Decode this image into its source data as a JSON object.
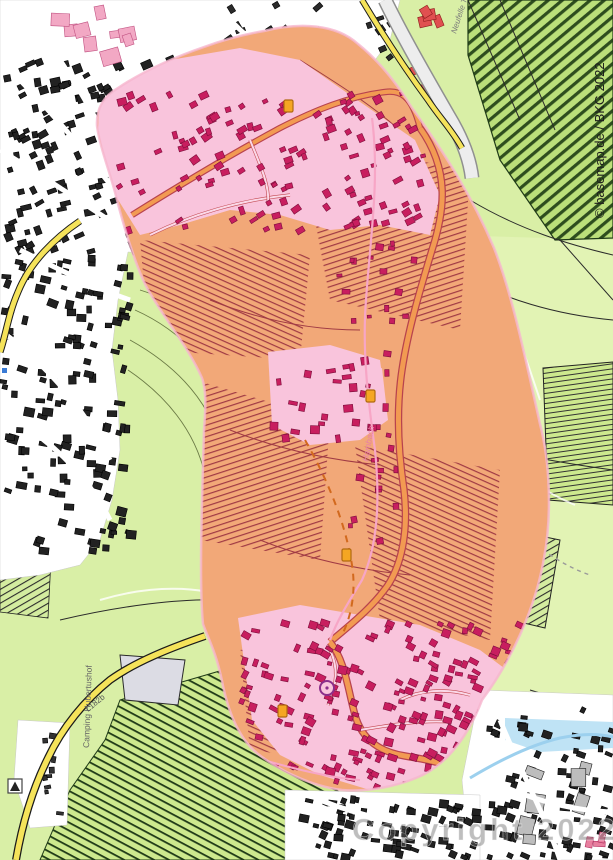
{
  "map": {
    "attribution": "© basemap.de / BKG 2022",
    "watermark": "Copyright 2022",
    "labels": {
      "camping": "Camping Hubertushof",
      "road": "L182b",
      "stream": "Hambach",
      "street": "Neufelle T."
    },
    "colors": {
      "field_green": "#D9EFA6",
      "pale_field": "#EFF6C8",
      "vine_dark": "#1F3A17",
      "urban_white": "#FFFFFF",
      "building_black": "#222222",
      "zone_orange": "#F2A878",
      "zone_pink_urban": "#F9C4DC",
      "zone_building_red": "#C81E5F",
      "zone_line_maroon": "#A03A44",
      "road_yellow": "#F5E35A",
      "road_orange": "#F29A52",
      "road_casing_red": "#B8434E",
      "stream_blue": "#BFE3F5",
      "stream_pink": "#F7A6C6",
      "shield_orange": "#F5A623"
    },
    "zones": [
      {
        "name": "impact-zone",
        "description": "red/orange analysis overlay blob covering the valley",
        "fill": "#F2A878",
        "urban_tint": "#F9C4DC"
      }
    ],
    "markers": {
      "route_shields": [
        {
          "x": 284,
          "y": 100
        },
        {
          "x": 366,
          "y": 390
        },
        {
          "x": 278,
          "y": 705
        },
        {
          "x": 342,
          "y": 549
        }
      ],
      "campsite": {
        "x": 8,
        "y": 779
      },
      "info_point": {
        "x": 2,
        "y": 368
      }
    },
    "building_clusters": [
      {
        "id": "b1",
        "x": 2,
        "y": 58,
        "w": 200,
        "h": 195,
        "n": 170,
        "s": 6.5,
        "rot": -20,
        "fill": "#222222",
        "stroke": "#000000"
      },
      {
        "id": "b2",
        "x": 0,
        "y": 255,
        "w": 128,
        "h": 295,
        "n": 130,
        "s": 6.5,
        "rot": 10,
        "fill": "#222222",
        "stroke": "#000000"
      },
      {
        "id": "b3",
        "x": 215,
        "y": 4,
        "w": 175,
        "h": 105,
        "n": 60,
        "s": 6,
        "rot": -30,
        "fill": "#2a2a2a",
        "stroke": "#000000"
      },
      {
        "id": "b4",
        "x": 487,
        "y": 705,
        "w": 124,
        "h": 150,
        "n": 75,
        "s": 6,
        "rot": 15,
        "fill": "#222222",
        "stroke": "#000000"
      },
      {
        "id": "b5",
        "x": 300,
        "y": 795,
        "w": 200,
        "h": 60,
        "n": 80,
        "s": 6,
        "rot": 15,
        "fill": "#222222",
        "stroke": "#000000"
      },
      {
        "id": "b6",
        "x": 40,
        "y": 728,
        "w": 22,
        "h": 84,
        "n": 9,
        "s": 5,
        "rot": 0,
        "fill": "#333333",
        "stroke": "#000000"
      },
      {
        "id": "apts",
        "x": 518,
        "y": 758,
        "w": 80,
        "h": 85,
        "n": 7,
        "s": 15,
        "rot": 10,
        "fill": "#BDBDBD",
        "stroke": "#1A1A1A"
      },
      {
        "id": "redtop",
        "x": 396,
        "y": 2,
        "w": 44,
        "h": 18,
        "n": 4,
        "s": 9,
        "rot": -20,
        "fill": "#E05050",
        "stroke": "#8B1A1A"
      },
      {
        "id": "redtop2",
        "x": 408,
        "y": 62,
        "w": 36,
        "h": 26,
        "n": 4,
        "s": 8,
        "rot": -20,
        "fill": "#E05050",
        "stroke": "#8B1A1A"
      },
      {
        "id": "redbr",
        "x": 584,
        "y": 826,
        "w": 24,
        "h": 26,
        "n": 3,
        "s": 8,
        "rot": 0,
        "fill": "#E87E9E",
        "stroke": "#B03060"
      },
      {
        "id": "pinkcomplex",
        "x": 44,
        "y": 2,
        "w": 80,
        "h": 50,
        "n": 9,
        "s": 12,
        "rot": -8,
        "fill": "#F2A8C4",
        "stroke": "#C05080"
      },
      {
        "id": "z1",
        "x": 112,
        "y": 92,
        "w": 310,
        "h": 140,
        "n": 130,
        "s": 6,
        "rot": -25,
        "fill": "#C81E5F",
        "stroke": "#7D0E3C"
      },
      {
        "id": "z2",
        "x": 268,
        "y": 350,
        "w": 118,
        "h": 88,
        "n": 28,
        "s": 6,
        "rot": 0,
        "fill": "#C81E5F",
        "stroke": "#7D0E3C"
      },
      {
        "id": "z3",
        "x": 240,
        "y": 618,
        "w": 290,
        "h": 172,
        "n": 210,
        "s": 6,
        "rot": 20,
        "fill": "#C81E5F",
        "stroke": "#7D0E3C"
      },
      {
        "id": "z4",
        "x": 330,
        "y": 235,
        "w": 85,
        "h": 85,
        "n": 16,
        "s": 5,
        "rot": 0,
        "fill": "#C81E5F",
        "stroke": "#7D0E3C"
      },
      {
        "id": "z5",
        "x": 345,
        "y": 430,
        "w": 60,
        "h": 115,
        "n": 13,
        "s": 5,
        "rot": 0,
        "fill": "#C81E5F",
        "stroke": "#7D0E3C"
      }
    ]
  }
}
